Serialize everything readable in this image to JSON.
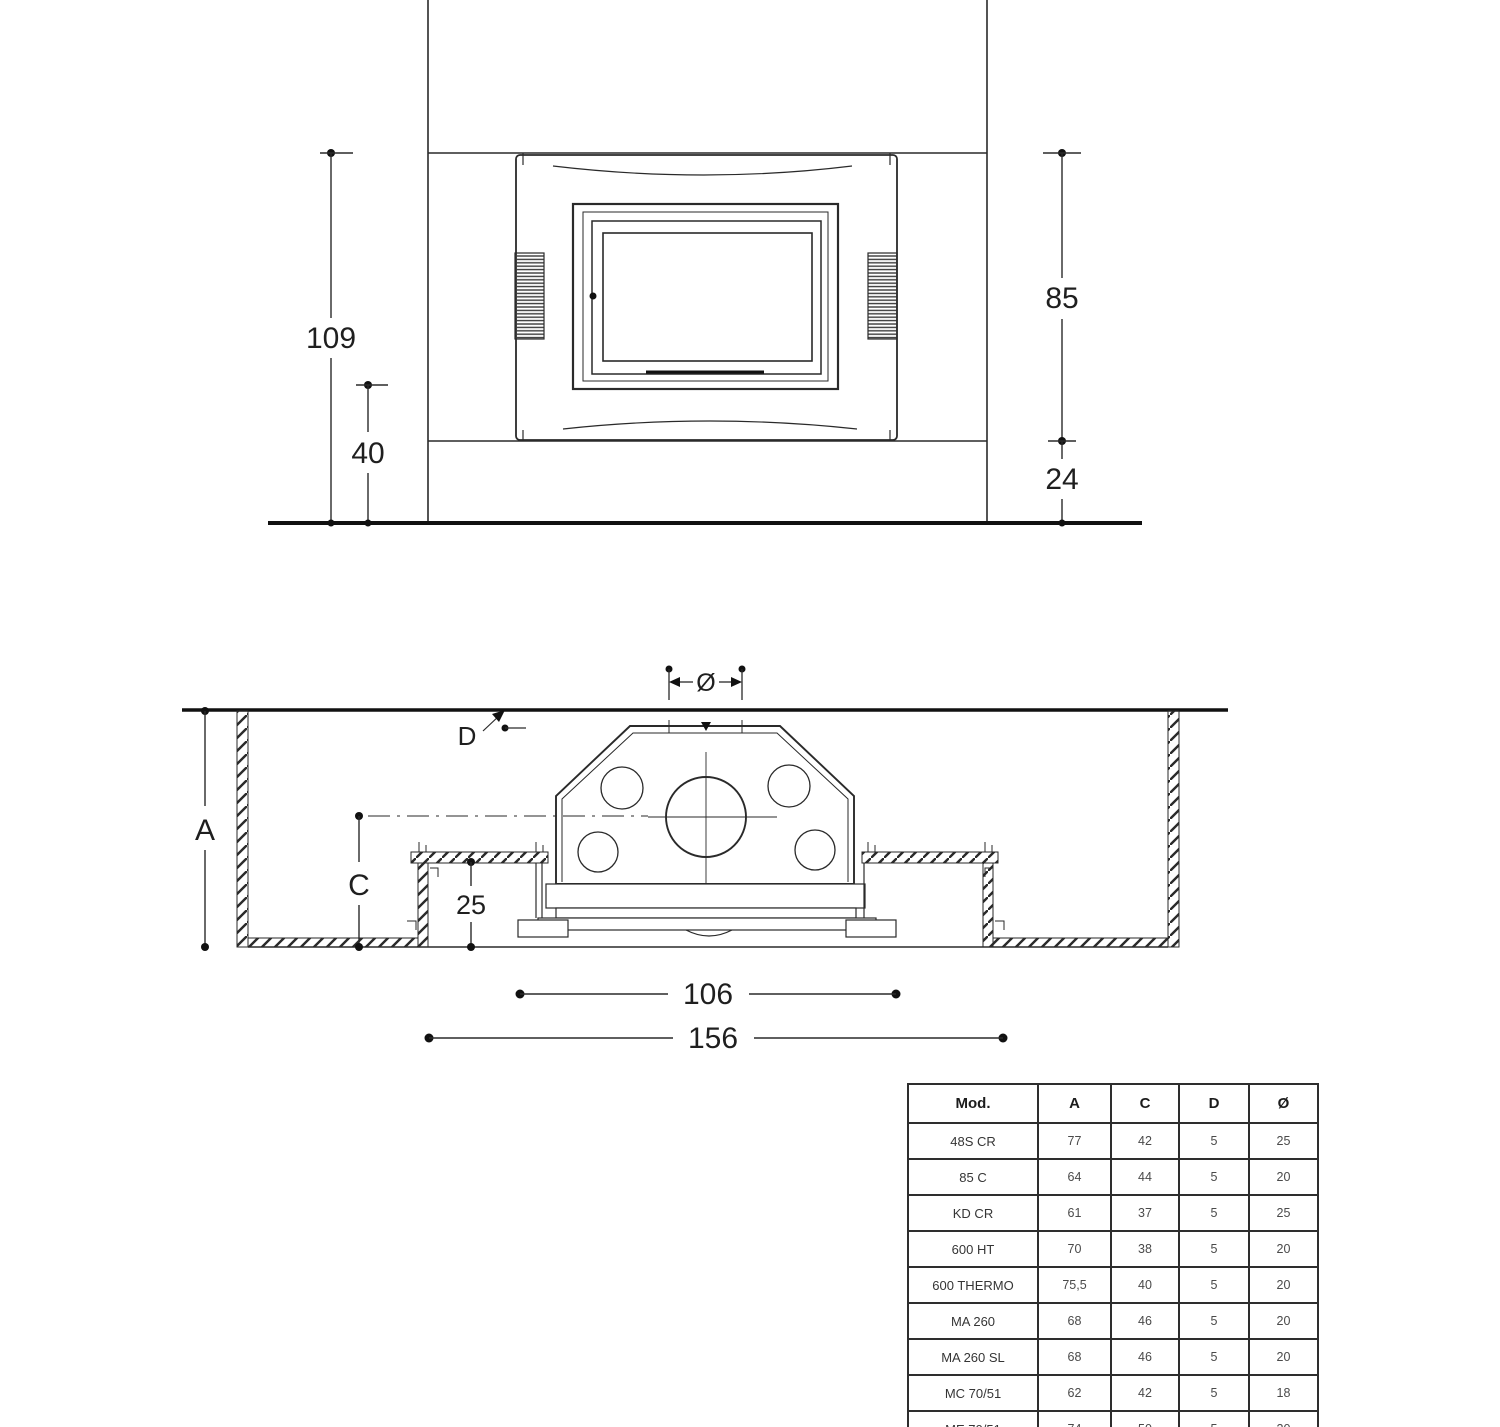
{
  "front_view": {
    "dim_total_height": "109",
    "dim_base_height": "40",
    "dim_firebox_height": "85",
    "dim_plinth_height": "24"
  },
  "section_view": {
    "dim_flue_diameter": "Ø",
    "dim_top_gap": "D",
    "dim_depth_total": "A",
    "dim_depth_bench": "C",
    "dim_bench_height": "25",
    "dim_inner_width": "106",
    "dim_outer_width": "156"
  },
  "spec_table": {
    "headers": {
      "mod": "Mod.",
      "a": "A",
      "c": "C",
      "d": "D",
      "diam": "Ø"
    },
    "rows": [
      {
        "mod": "48S CR",
        "a": "77",
        "c": "42",
        "d": "5",
        "diam": "25"
      },
      {
        "mod": "85 C",
        "a": "64",
        "c": "44",
        "d": "5",
        "diam": "20"
      },
      {
        "mod": "KD CR",
        "a": "61",
        "c": "37",
        "d": "5",
        "diam": "25"
      },
      {
        "mod": "600 HT",
        "a": "70",
        "c": "38",
        "d": "5",
        "diam": "20"
      },
      {
        "mod": "600 THERMO",
        "a": "75,5",
        "c": "40",
        "d": "5",
        "diam": "20"
      },
      {
        "mod": "MA 260",
        "a": "68",
        "c": "46",
        "d": "5",
        "diam": "20"
      },
      {
        "mod": "MA 260 SL",
        "a": "68",
        "c": "46",
        "d": "5",
        "diam": "20"
      },
      {
        "mod": "MC 70/51",
        "a": "62",
        "c": "42",
        "d": "5",
        "diam": "18"
      },
      {
        "mod": "ME 70/51",
        "a": "74",
        "c": "50",
        "d": "5",
        "diam": "20"
      }
    ]
  }
}
